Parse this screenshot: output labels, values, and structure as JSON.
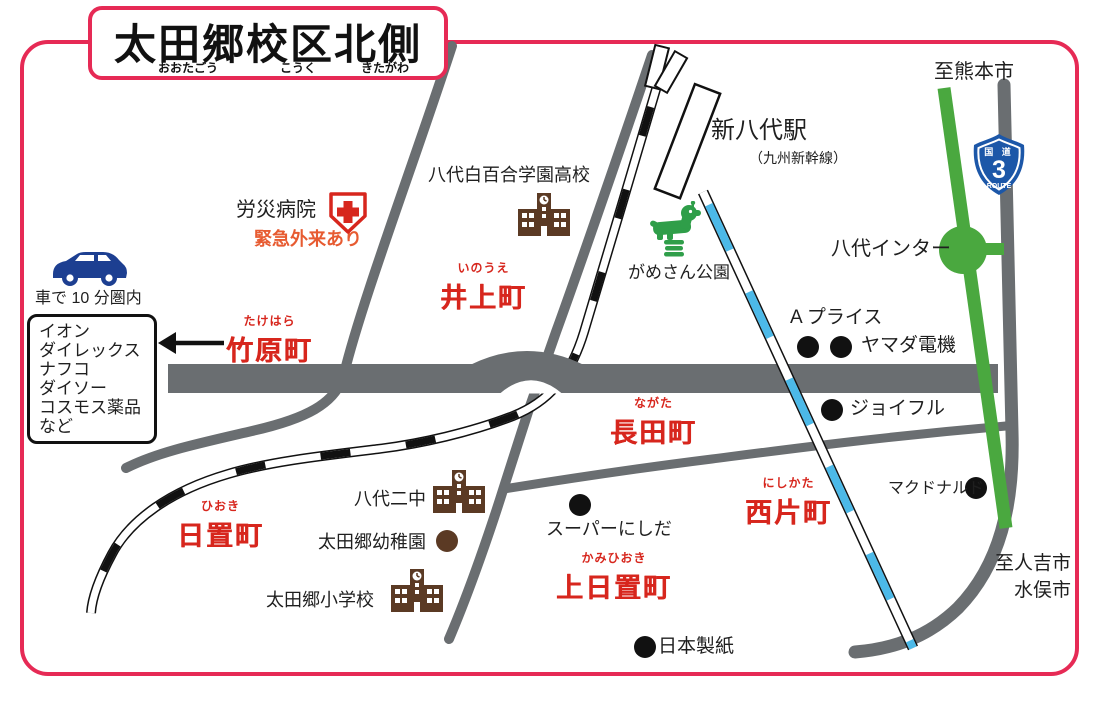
{
  "title": {
    "main": "太田郷校区北側",
    "furigana": {
      "f1": "おおたごう",
      "f2": "こうく",
      "f3": "きたがわ"
    }
  },
  "directions": {
    "to_kumamoto": "至熊本市",
    "to_hitoyoshi": "至人吉市",
    "to_minamata": "水俣市"
  },
  "station": {
    "name": "新八代駅",
    "line": "（九州新幹線）"
  },
  "route_shield": {
    "kokudo": "国 道",
    "number": "3",
    "route": "ROUTE"
  },
  "interchange": {
    "label": "八代インター"
  },
  "towns": [
    {
      "furigana": "いのうえ",
      "name": "井上町"
    },
    {
      "furigana": "たけはら",
      "name": "竹原町"
    },
    {
      "furigana": "ながた",
      "name": "長田町"
    },
    {
      "furigana": "ひおき",
      "name": "日置町"
    },
    {
      "furigana": "にしかた",
      "name": "西片町"
    },
    {
      "furigana": "かみひおき",
      "name": "上日置町"
    }
  ],
  "landmarks": {
    "hospital": "労災病院",
    "hospital_note": "緊急外来あり",
    "highschool": "八代白百合学園高校",
    "park": "がめさん公園",
    "junior_high": "八代二中",
    "kindergarten": "太田郷幼稚園",
    "elementary": "太田郷小学校",
    "a_price": "A プライス",
    "yamada_denki": "ヤマダ電機",
    "joyful": "ジョイフル",
    "super_nishida": "スーパーにしだ",
    "mcdonalds": "マクドナルド",
    "nippon_paper": "日本製紙"
  },
  "car_zone": {
    "label": "車で 10 分圏内",
    "stores": [
      "イオン",
      "ダイレックス",
      "ナフコ",
      "ダイソー",
      "コスモス薬品",
      "など"
    ]
  },
  "colors": {
    "border_pink": "#e62a55",
    "town_red": "#d7261d",
    "road_gray": "#6a6e71",
    "expressway_green": "#4aa83f",
    "shinkansen_blue": "#4cb9e8",
    "shield_blue": "#1c57a8",
    "landmark_brown": "#5b3a24",
    "note_orange": "#e75b31",
    "car_blue": "#1d3f91"
  }
}
